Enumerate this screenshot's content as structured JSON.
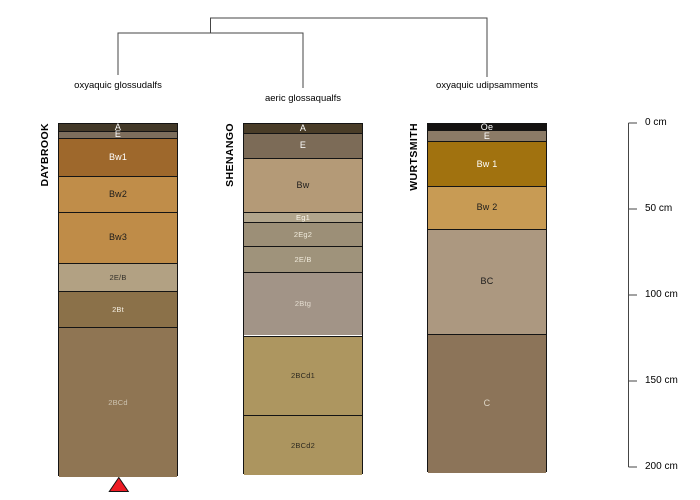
{
  "chart_data": {
    "type": "soil-profile-dendrogram",
    "title": "",
    "depth_axis": {
      "unit": "cm",
      "side": "right",
      "ticks": [
        {
          "value": 0,
          "label": "0 cm"
        },
        {
          "value": 50,
          "label": "50 cm"
        },
        {
          "value": 100,
          "label": "100 cm"
        },
        {
          "value": 150,
          "label": "150 cm"
        },
        {
          "value": 200,
          "label": "200 cm"
        }
      ]
    },
    "dendrogram": {
      "structure": "((DAYBROOK,SHENANGO),WURTSMITH)",
      "line_color": "#454545"
    },
    "profiles": [
      {
        "name": "DAYBROOK",
        "taxon": "oxyaquic glossudalfs",
        "horizons": [
          {
            "label": "A",
            "top_cm": 0,
            "bottom_cm": 4,
            "color": "#433928",
            "label_color": "#ffffff"
          },
          {
            "label": "E",
            "top_cm": 4,
            "bottom_cm": 8,
            "color": "#7d6e5c",
            "label_color": "#ffffff"
          },
          {
            "label": "Bw1",
            "top_cm": 8,
            "bottom_cm": 30,
            "color": "#9e682c",
            "label_color": "#ffffff"
          },
          {
            "label": "Bw2",
            "top_cm": 30,
            "bottom_cm": 51,
            "color": "#c08d49",
            "label_color": "#1c1c1c"
          },
          {
            "label": "Bw3",
            "top_cm": 51,
            "bottom_cm": 81,
            "color": "#bf8c48",
            "label_color": "#1c1c1c"
          },
          {
            "label": "2E/B",
            "top_cm": 81,
            "bottom_cm": 97,
            "color": "#b2a183",
            "label_color": "#33302a"
          },
          {
            "label": "2Bt",
            "top_cm": 97,
            "bottom_cm": 118,
            "color": "#8b7149",
            "label_color": "#f5efe2"
          },
          {
            "label": "2BCd",
            "top_cm": 118,
            "bottom_cm": 205,
            "color": "#8f7553",
            "label_color": "#cdc3b0"
          }
        ]
      },
      {
        "name": "SHENANGO",
        "taxon": "aeric glossaqualfs",
        "horizons": [
          {
            "label": "A",
            "top_cm": 0,
            "bottom_cm": 5,
            "color": "#4a3d28",
            "label_color": "#ffffff"
          },
          {
            "label": "E",
            "top_cm": 5,
            "bottom_cm": 20,
            "color": "#7c6b57",
            "label_color": "#ffffff"
          },
          {
            "label": "Bw",
            "top_cm": 20,
            "bottom_cm": 51,
            "color": "#b49a77",
            "label_color": "#1c1c1c"
          },
          {
            "label": "Eg1",
            "top_cm": 51,
            "bottom_cm": 57,
            "color": "#b1a58c",
            "label_color": "#fbf7ec"
          },
          {
            "label": "2Eg2",
            "top_cm": 57,
            "bottom_cm": 71,
            "color": "#9c8f77",
            "label_color": "#efe9da"
          },
          {
            "label": "2E/B",
            "top_cm": 71,
            "bottom_cm": 86,
            "color": "#9f937b",
            "label_color": "#efe9da"
          },
          {
            "label": "2Btg",
            "top_cm": 86,
            "bottom_cm": 123,
            "color": "#a29487",
            "label_color": "#e3dccf"
          },
          {
            "label": "2BCd1",
            "top_cm": 123,
            "bottom_cm": 169,
            "color": "#ad9660",
            "label_color": "#2e2a20"
          },
          {
            "label": "2BCd2",
            "top_cm": 169,
            "bottom_cm": 204,
            "color": "#ac955f",
            "label_color": "#2e2a20"
          }
        ]
      },
      {
        "name": "WURTSMITH",
        "taxon": "oxyaquic udipsamments",
        "horizons": [
          {
            "label": "Oe",
            "top_cm": 0,
            "bottom_cm": 3.5,
            "color": "#141210",
            "label_color": "#ffffff"
          },
          {
            "label": "E",
            "top_cm": 3.5,
            "bottom_cm": 10,
            "color": "#8b7b67",
            "label_color": "#ffffff"
          },
          {
            "label": "Bw 1",
            "top_cm": 10,
            "bottom_cm": 36,
            "color": "#a1720f",
            "label_color": "#ffffff"
          },
          {
            "label": "Bw 2",
            "top_cm": 36,
            "bottom_cm": 61,
            "color": "#c89b54",
            "label_color": "#1c1c1c"
          },
          {
            "label": "BC",
            "top_cm": 61,
            "bottom_cm": 122,
            "color": "#ac9880",
            "label_color": "#1c1c1c"
          },
          {
            "label": "C",
            "top_cm": 122,
            "bottom_cm": 203,
            "color": "#8c7459",
            "label_color": "#ded6c6"
          }
        ]
      }
    ],
    "marker": {
      "shape": "triangle-up",
      "fill": "#ee1c25",
      "outline": "#141414",
      "below_profile": "DAYBROOK"
    }
  }
}
